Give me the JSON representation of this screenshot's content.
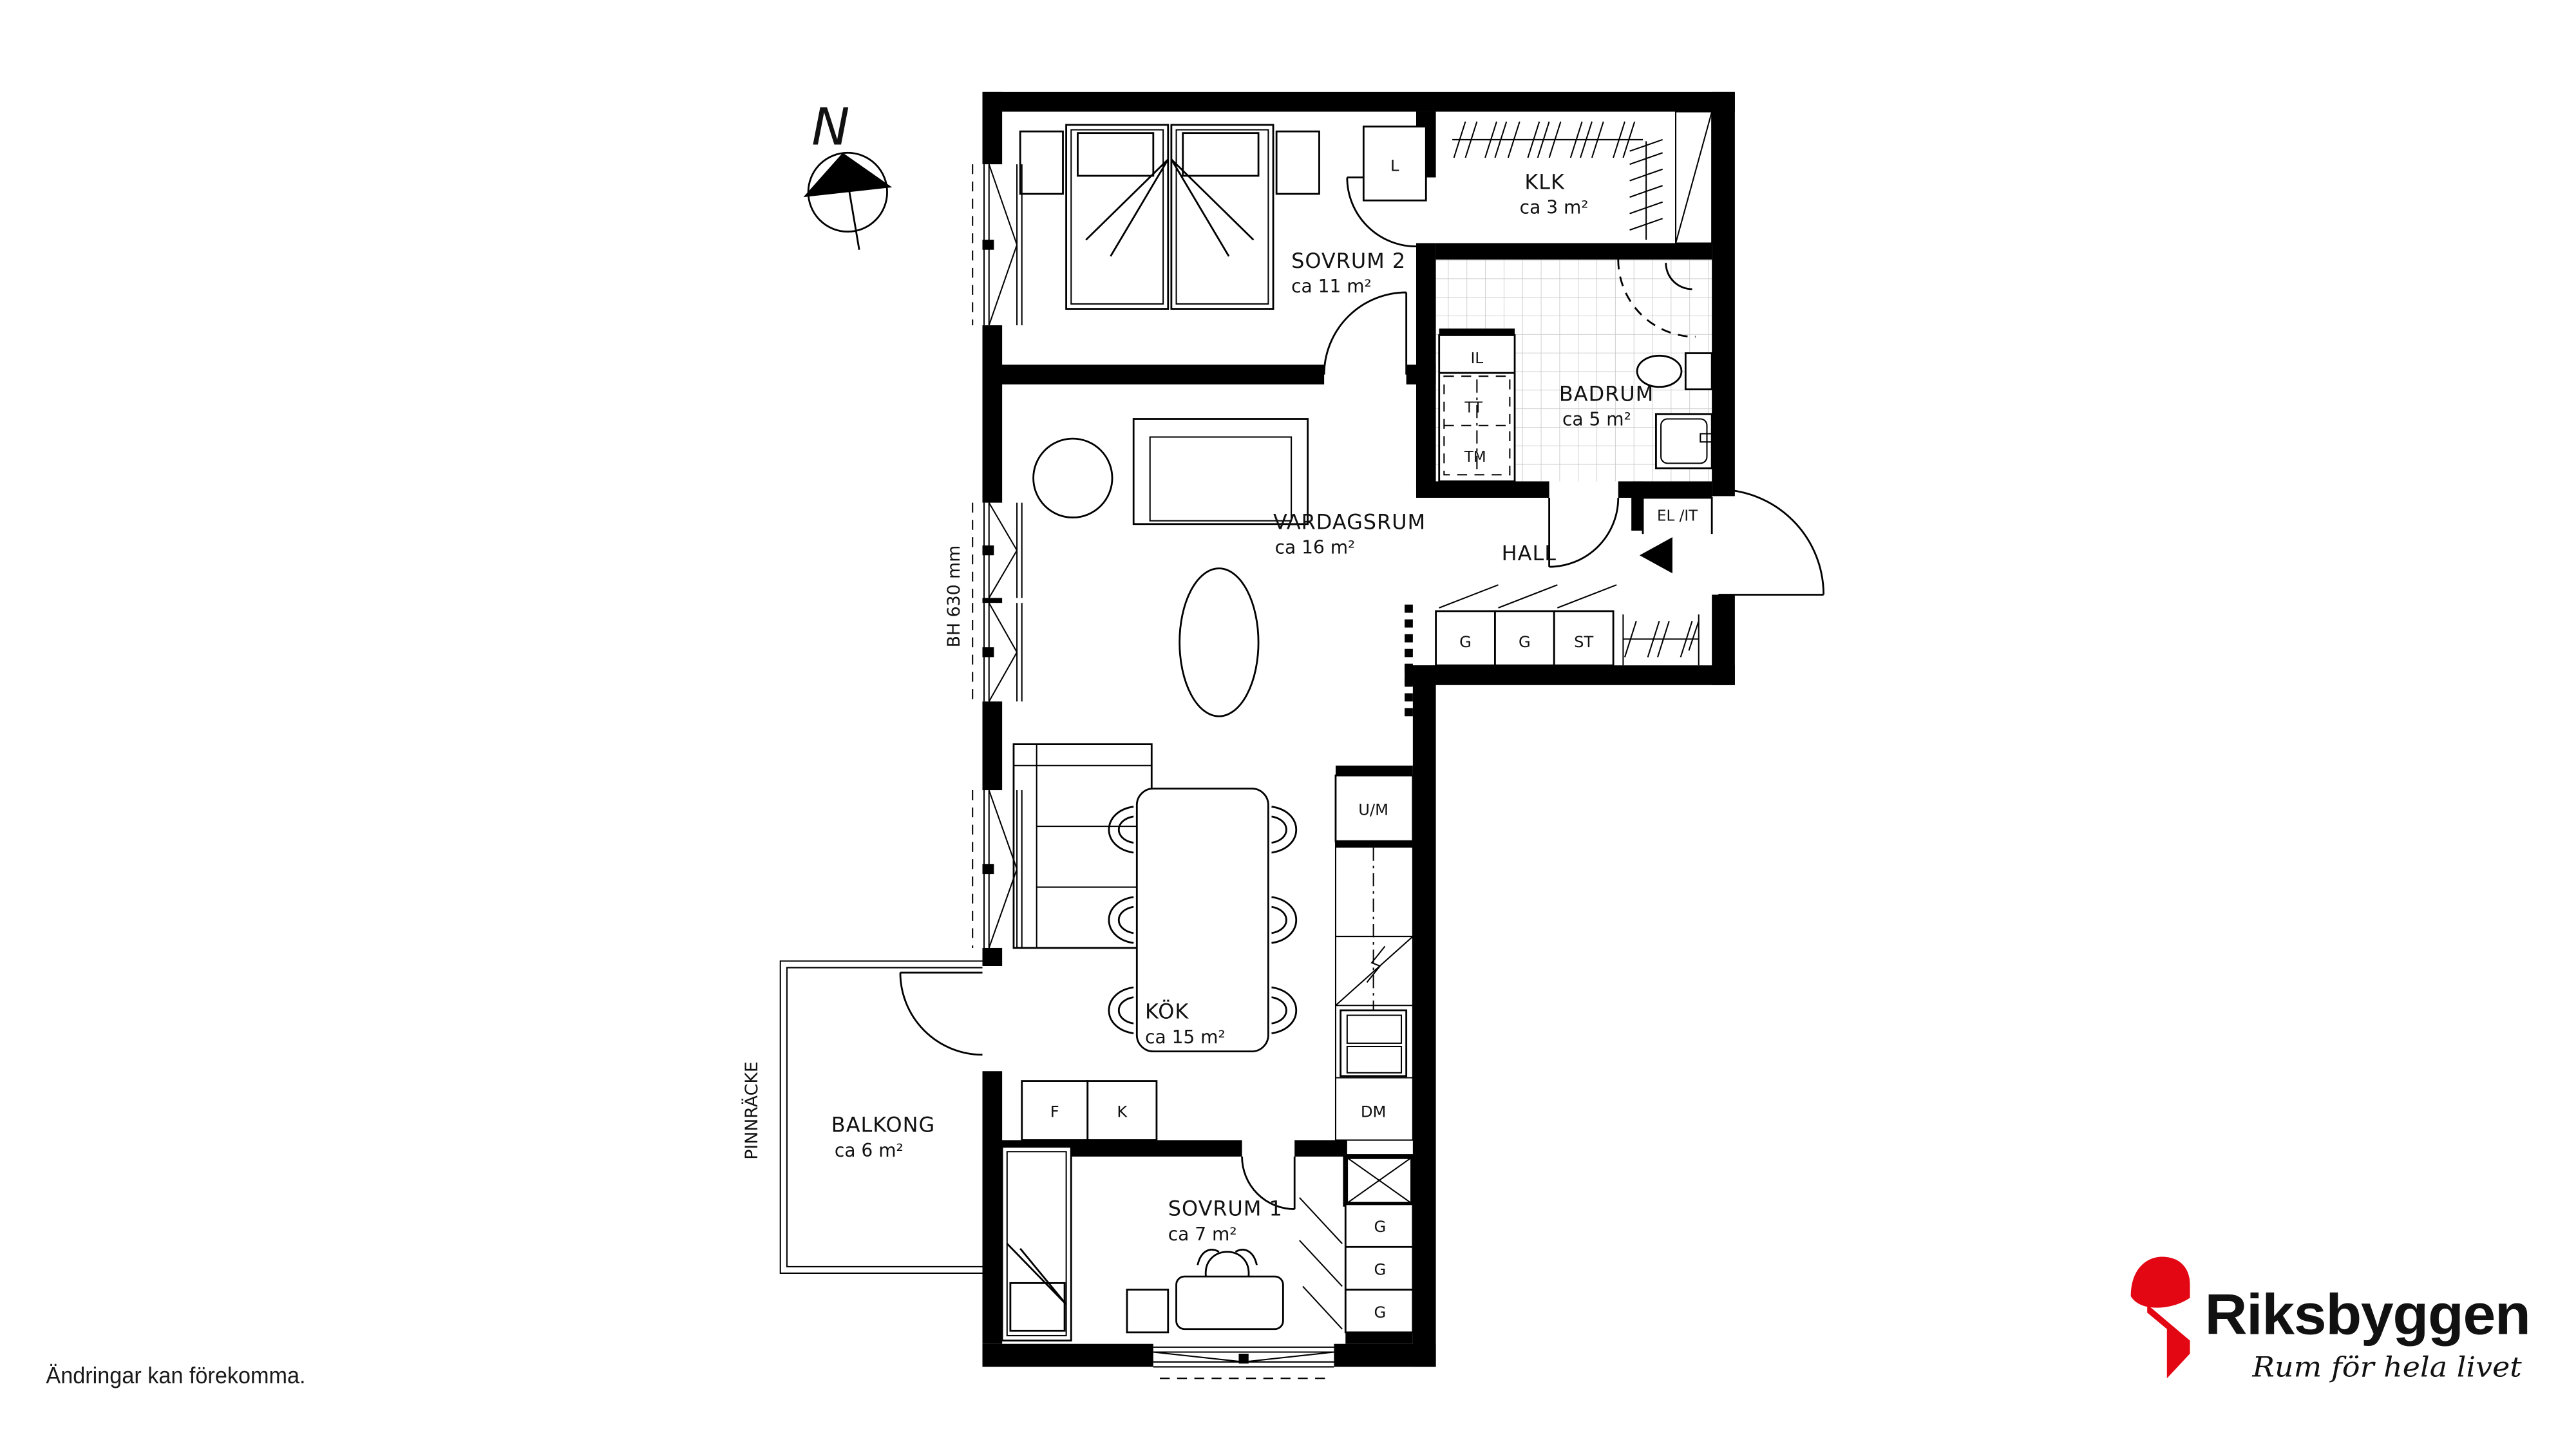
{
  "compass": {
    "label": "N"
  },
  "rooms": {
    "sovrum2": {
      "name": "SOVRUM 2",
      "area": "ca 11 m²"
    },
    "klk": {
      "name": "KLK",
      "area": "ca 3 m²"
    },
    "badrum": {
      "name": "BADRUM",
      "area": "ca 5 m²"
    },
    "vardagsrum": {
      "name": "VARDAGSRUM",
      "area": "ca 16 m²"
    },
    "hall": {
      "name": "HALL"
    },
    "kok": {
      "name": "KÖK",
      "area": "ca 15 m²"
    },
    "balkong": {
      "name": "BALKONG",
      "area": "ca 6 m²"
    },
    "sovrum1": {
      "name": "SOVRUM 1",
      "area": "ca 7 m²"
    }
  },
  "fixtures": {
    "linen": "L",
    "il": "IL",
    "tt": "TT",
    "tm": "TM",
    "el_it": "EL /IT",
    "wardrobe": "G",
    "cleaning": "ST",
    "oven_micro": "U/M",
    "dishwasher": "DM",
    "freezer": "F",
    "fridge": "K"
  },
  "annotations": {
    "window_height": "BH 630 mm",
    "railing": "PINNRÄCKE",
    "disclaimer": "Ändringar kan förekomma."
  },
  "logo": {
    "brand": "Riksbyggen",
    "tagline": "Rum för hela livet",
    "brand_color": "#8b8b8d",
    "mark_color": "#e30613",
    "tagline_color": "#000000"
  }
}
